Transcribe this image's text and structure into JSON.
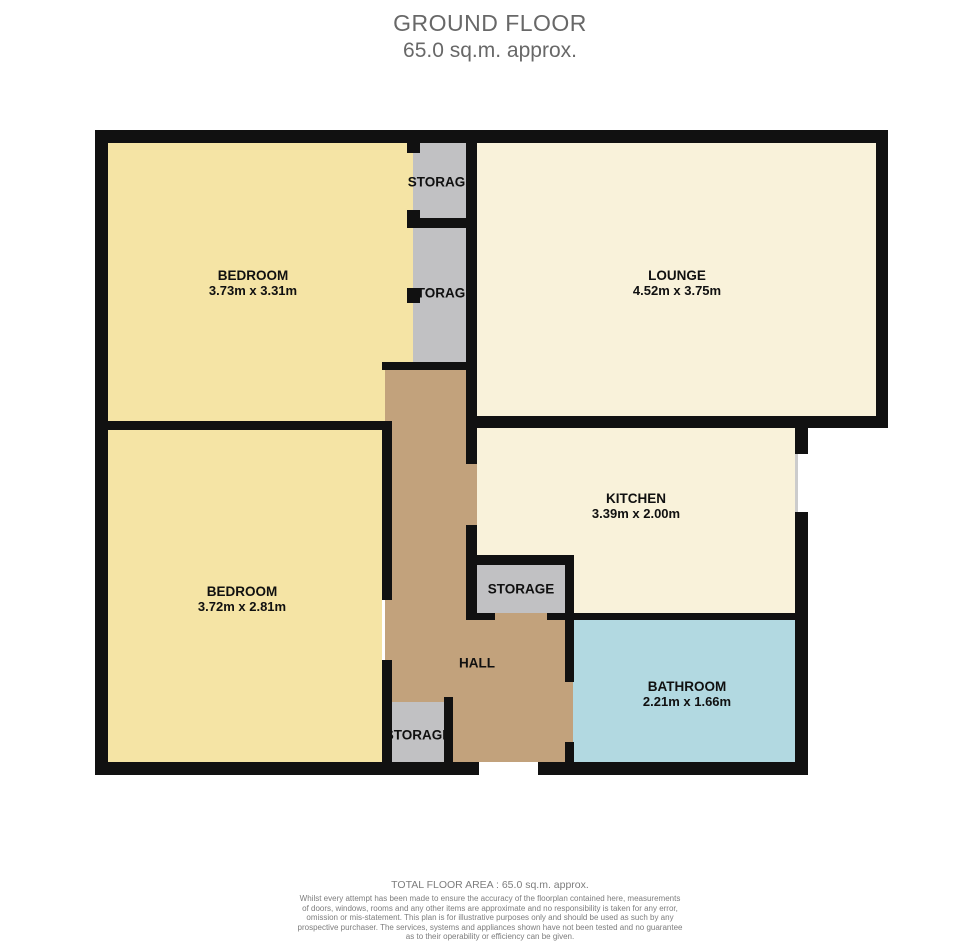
{
  "title": {
    "line1": "GROUND FLOOR",
    "line2": "65.0 sq.m. approx."
  },
  "rooms": {
    "bedroom_top": {
      "name": "BEDROOM",
      "dims": "3.73m  x 3.31m"
    },
    "lounge": {
      "name": "LOUNGE",
      "dims": "4.52m  x 3.75m"
    },
    "bedroom_bottom": {
      "name": "BEDROOM",
      "dims": "3.72m  x 2.81m"
    },
    "kitchen": {
      "name": "KITCHEN",
      "dims": "3.39m  x 2.00m"
    },
    "bathroom": {
      "name": "BATHROOM",
      "dims": "2.21m  x 1.66m"
    },
    "hall": {
      "name": "HALL"
    },
    "storage_top": {
      "name": "STORAGE"
    },
    "storage_second": {
      "name": "STORAGE"
    },
    "storage_mid": {
      "name": "STORAGE"
    },
    "storage_hall": {
      "name": "STORAGE"
    }
  },
  "colors": {
    "bedroom": "#f5e4a5",
    "lounge": "#f9f2da",
    "kitchen": "#f9f2da",
    "storage": "#c1c1c3",
    "hall": "#c2a27c",
    "bathroom": "#b2d9e1",
    "wall": "#111111",
    "window": "#cccccc"
  },
  "footer": {
    "total": "TOTAL FLOOR AREA : 65.0 sq.m. approx.",
    "disclaimer": [
      "Whilst every attempt has been made to ensure the accuracy of the floorplan contained here, measurements",
      "of doors, windows, rooms and any other items are approximate and no responsibility is taken for any error,",
      "omission or mis-statement. This plan is for illustrative purposes only and should be used as such by any",
      "prospective purchaser. The services, systems and appliances shown have not been tested and no guarantee",
      "as to their operability or efficiency can be given."
    ],
    "credit": "Made with Metropix ©2025"
  }
}
